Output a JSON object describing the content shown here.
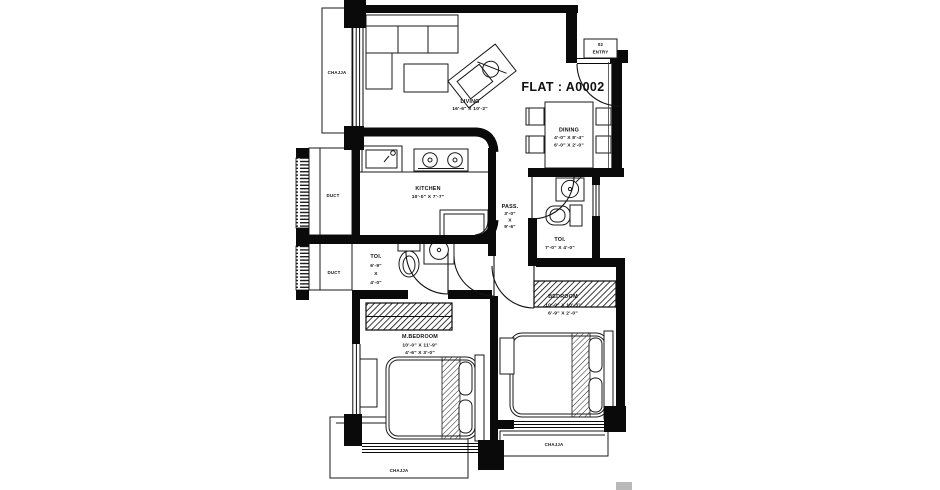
{
  "plan": {
    "flat_title": "FLAT : A0002",
    "entry": {
      "code": "02",
      "label": "ENTRY"
    }
  },
  "rooms": {
    "living": {
      "name": "LIVING",
      "size": "16'-6\" X 10'-2\""
    },
    "dining": {
      "name": "DINING",
      "size1": "4'-0\" X 8'-4\"",
      "size2": "6'-0\" X 2'-0\""
    },
    "kitchen": {
      "name": "KITCHEN",
      "size": "10'-0\" X 7'-7\""
    },
    "passage": {
      "name": "PASS.",
      "w": "3'-0\"",
      "x": "X",
      "h": "9'-6\""
    },
    "toilet_common": {
      "name": "TOI.",
      "size": "7'-0\" X 4'-0\""
    },
    "toilet_master": {
      "name": "TOI.",
      "w": "6'-9\"",
      "x": "X",
      "h": "4'-0\""
    },
    "master_bedroom": {
      "name": "M.BEDROOM",
      "size1": "10'-0\" X 11'-9\"",
      "size2": "4'-6\" X 3'-0\""
    },
    "bedroom": {
      "name": "BEDROOM",
      "size1": "10'-0\" X 10'-3\"",
      "size2": "6'-9\" X 2'-0\""
    },
    "duct_kitchen": {
      "name": "DUCT"
    },
    "duct_toilet": {
      "name": "DUCT"
    }
  },
  "chajja": {
    "left": "CHAJJA",
    "master_bedroom": "CHAJJA",
    "bedroom": "CHAJJA"
  },
  "colors": {
    "wall": "#0a0a0a",
    "line": "#1a1a1a",
    "text": "#101010",
    "background": "#ffffff"
  }
}
